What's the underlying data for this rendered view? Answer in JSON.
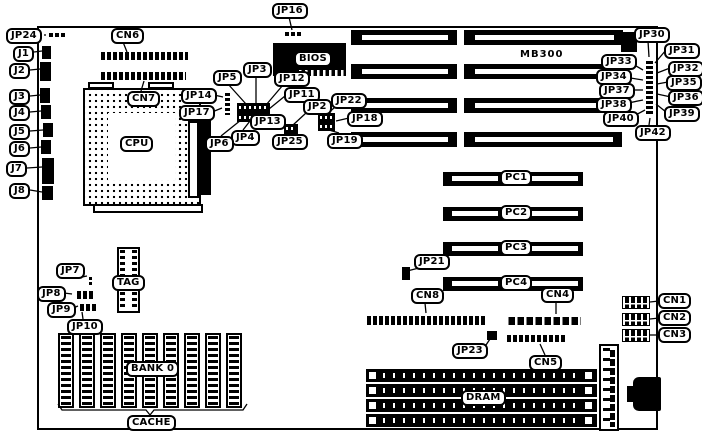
{
  "labels": {
    "jp24": "JP24",
    "j1": "J1",
    "j2": "J2",
    "j3": "J3",
    "j4": "J4",
    "j5": "J5",
    "j6": "J6",
    "j7": "J7",
    "j8": "J8",
    "jp16": "JP16",
    "cn6": "CN6",
    "cn7": "CN7",
    "cpu": "CPU",
    "bios": "BIOS",
    "jp5": "JP5",
    "jp3": "JP3",
    "jp12": "JP12",
    "jp11": "JP11",
    "jp2": "JP2",
    "jp13": "JP13",
    "jp4": "JP4",
    "jp6": "JP6",
    "jp25": "JP25",
    "jp14": "JP14",
    "jp17": "JP17",
    "jp22": "JP22",
    "jp18": "JP18",
    "jp19": "JP19",
    "mb300": "MB300",
    "jp30": "JP30",
    "jp31": "JP31",
    "jp32": "JP32",
    "jp33": "JP33",
    "jp34": "JP34",
    "jp35": "JP35",
    "jp36": "JP36",
    "jp37": "JP37",
    "jp38": "JP38",
    "jp39": "JP39",
    "jp40": "JP40",
    "jp42": "JP42",
    "pc1": "PC1",
    "pc2": "PC2",
    "pc3": "PC3",
    "pc4": "PC4",
    "jp21": "JP21",
    "cn8": "CN8",
    "cn4": "CN4",
    "cn5": "CN5",
    "jp23": "JP23",
    "cn1": "CN1",
    "cn2": "CN2",
    "cn3": "CN3",
    "jp7": "JP7",
    "jp8": "JP8",
    "jp9": "JP9",
    "jp10": "JP10",
    "tag": "TAG",
    "bank0": "BANK 0",
    "cache": "CACHE",
    "dram": "DRAM",
    "vrm_marking": "A"
  }
}
